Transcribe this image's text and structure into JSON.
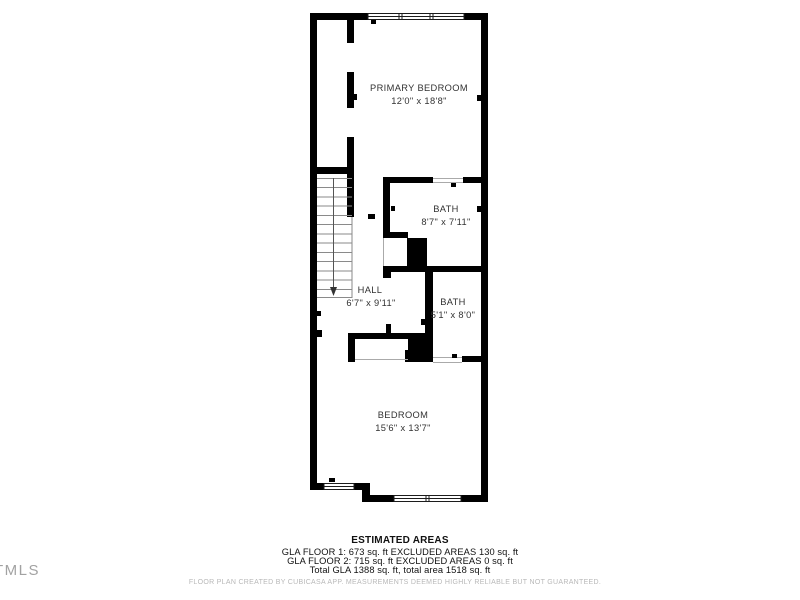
{
  "floor_plan": {
    "rooms": [
      {
        "name": "PRIMARY BEDROOM",
        "dims": "12'0\" x 18'8\""
      },
      {
        "name": "BATH",
        "dims": "8'7\" x 7'11\""
      },
      {
        "name": "HALL",
        "dims": "6'7\" x 9'11\""
      },
      {
        "name": "BATH",
        "dims": "5'1\" x 8'0\""
      },
      {
        "name": "BEDROOM",
        "dims": "15'6\" x 13'7\""
      }
    ],
    "stairs_direction": "down"
  },
  "estimated_areas": {
    "title": "ESTIMATED AREAS",
    "lines": [
      "GLA FLOOR 1: 673 sq. ft EXCLUDED AREAS 130 sq. ft",
      "GLA FLOOR 2: 715 sq. ft EXCLUDED AREAS 0 sq. ft",
      "Total GLA 1388 sq. ft, total area 1518 sq. ft"
    ]
  },
  "footer": {
    "disclaimer": "FLOOR PLAN CREATED BY CUBICASA APP. MEASUREMENTS DEEMED HIGHLY RELIABLE BUT NOT GUARANTEED."
  },
  "watermark": {
    "text": "TMLS"
  },
  "colors": {
    "wall": "#000000",
    "label_text": "#323232",
    "footer_text": "#111111",
    "disclaimer_text": "#b8b8b8",
    "watermark_text": "#a2a2a2"
  }
}
